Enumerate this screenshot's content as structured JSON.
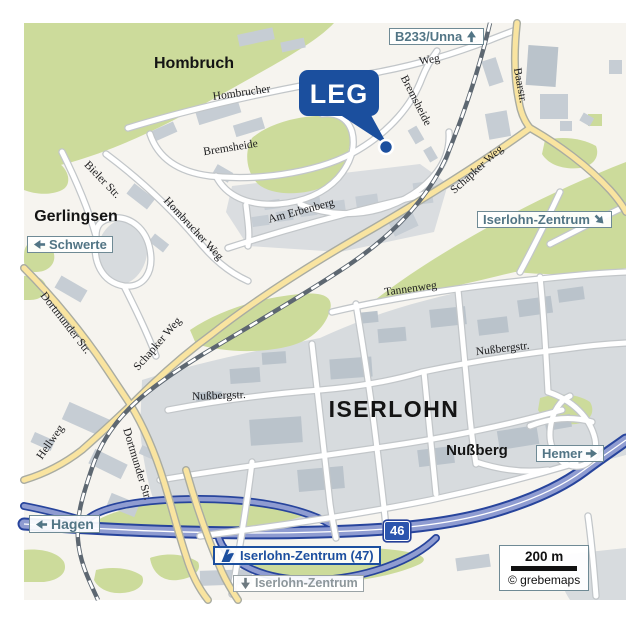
{
  "marker": {
    "label": "LEG"
  },
  "places": {
    "hombruch": "Hombruch",
    "gerlingsen": "Gerlingsen",
    "iserlohn": "ISERLOHN",
    "nussberg": "Nußberg"
  },
  "streets": {
    "hombrucher": "Hombrucher",
    "weg": "Weg",
    "bremsheide_nw": "Bremsheide",
    "bremsheide_e": "Bremsheide",
    "baarstr": "Baarstr.",
    "bieler_str": "Bieler Str.",
    "hombrucher_weg": "Hombrucher Weg",
    "am_erbenberg": "Am Erbenberg",
    "schapker_weg_ne": "Schapker Weg",
    "schapker_weg_sw": "Schapker Weg",
    "dortmunder_str_n": "Dortmunder Str.",
    "dortmunder_str_s": "Dortmunder Str.",
    "hellweg": "Hellweg",
    "tannenweg": "Tannenweg",
    "nussbergstr_e": "Nußbergstr.",
    "nussbergstr_w": "Nußbergstr."
  },
  "signs": {
    "b233_unna": {
      "label": "B233/Unna",
      "direction": "up"
    },
    "schwerte": {
      "label": "Schwerte",
      "direction": "left"
    },
    "iserlohn_zentrum_se": {
      "label": "Iserlohn-Zentrum",
      "direction": "down-right"
    },
    "hemer": {
      "label": "Hemer",
      "direction": "right"
    },
    "hagen": {
      "label": "Hagen",
      "direction": "left"
    },
    "autobahn_exit": {
      "label": "Iserlohn-Zentrum (47)"
    },
    "iserlohn_zentrum_s": {
      "label": "Iserlohn-Zentrum",
      "direction": "down"
    },
    "motorway_number": "46"
  },
  "scale": {
    "label": "200 m",
    "attribution": "© grebemaps"
  },
  "colors": {
    "marker_blue": "#1b4f9e",
    "motorway_blue": "#27449c",
    "motorway_fill": "#8f9cd1",
    "sign_teal": "#527585",
    "green_area": "#ccdb9b",
    "urban_gray": "#d7dbde",
    "yellow_road": "#f9e4a0",
    "railway": "#5d6771",
    "background": "#f6f4ef"
  }
}
